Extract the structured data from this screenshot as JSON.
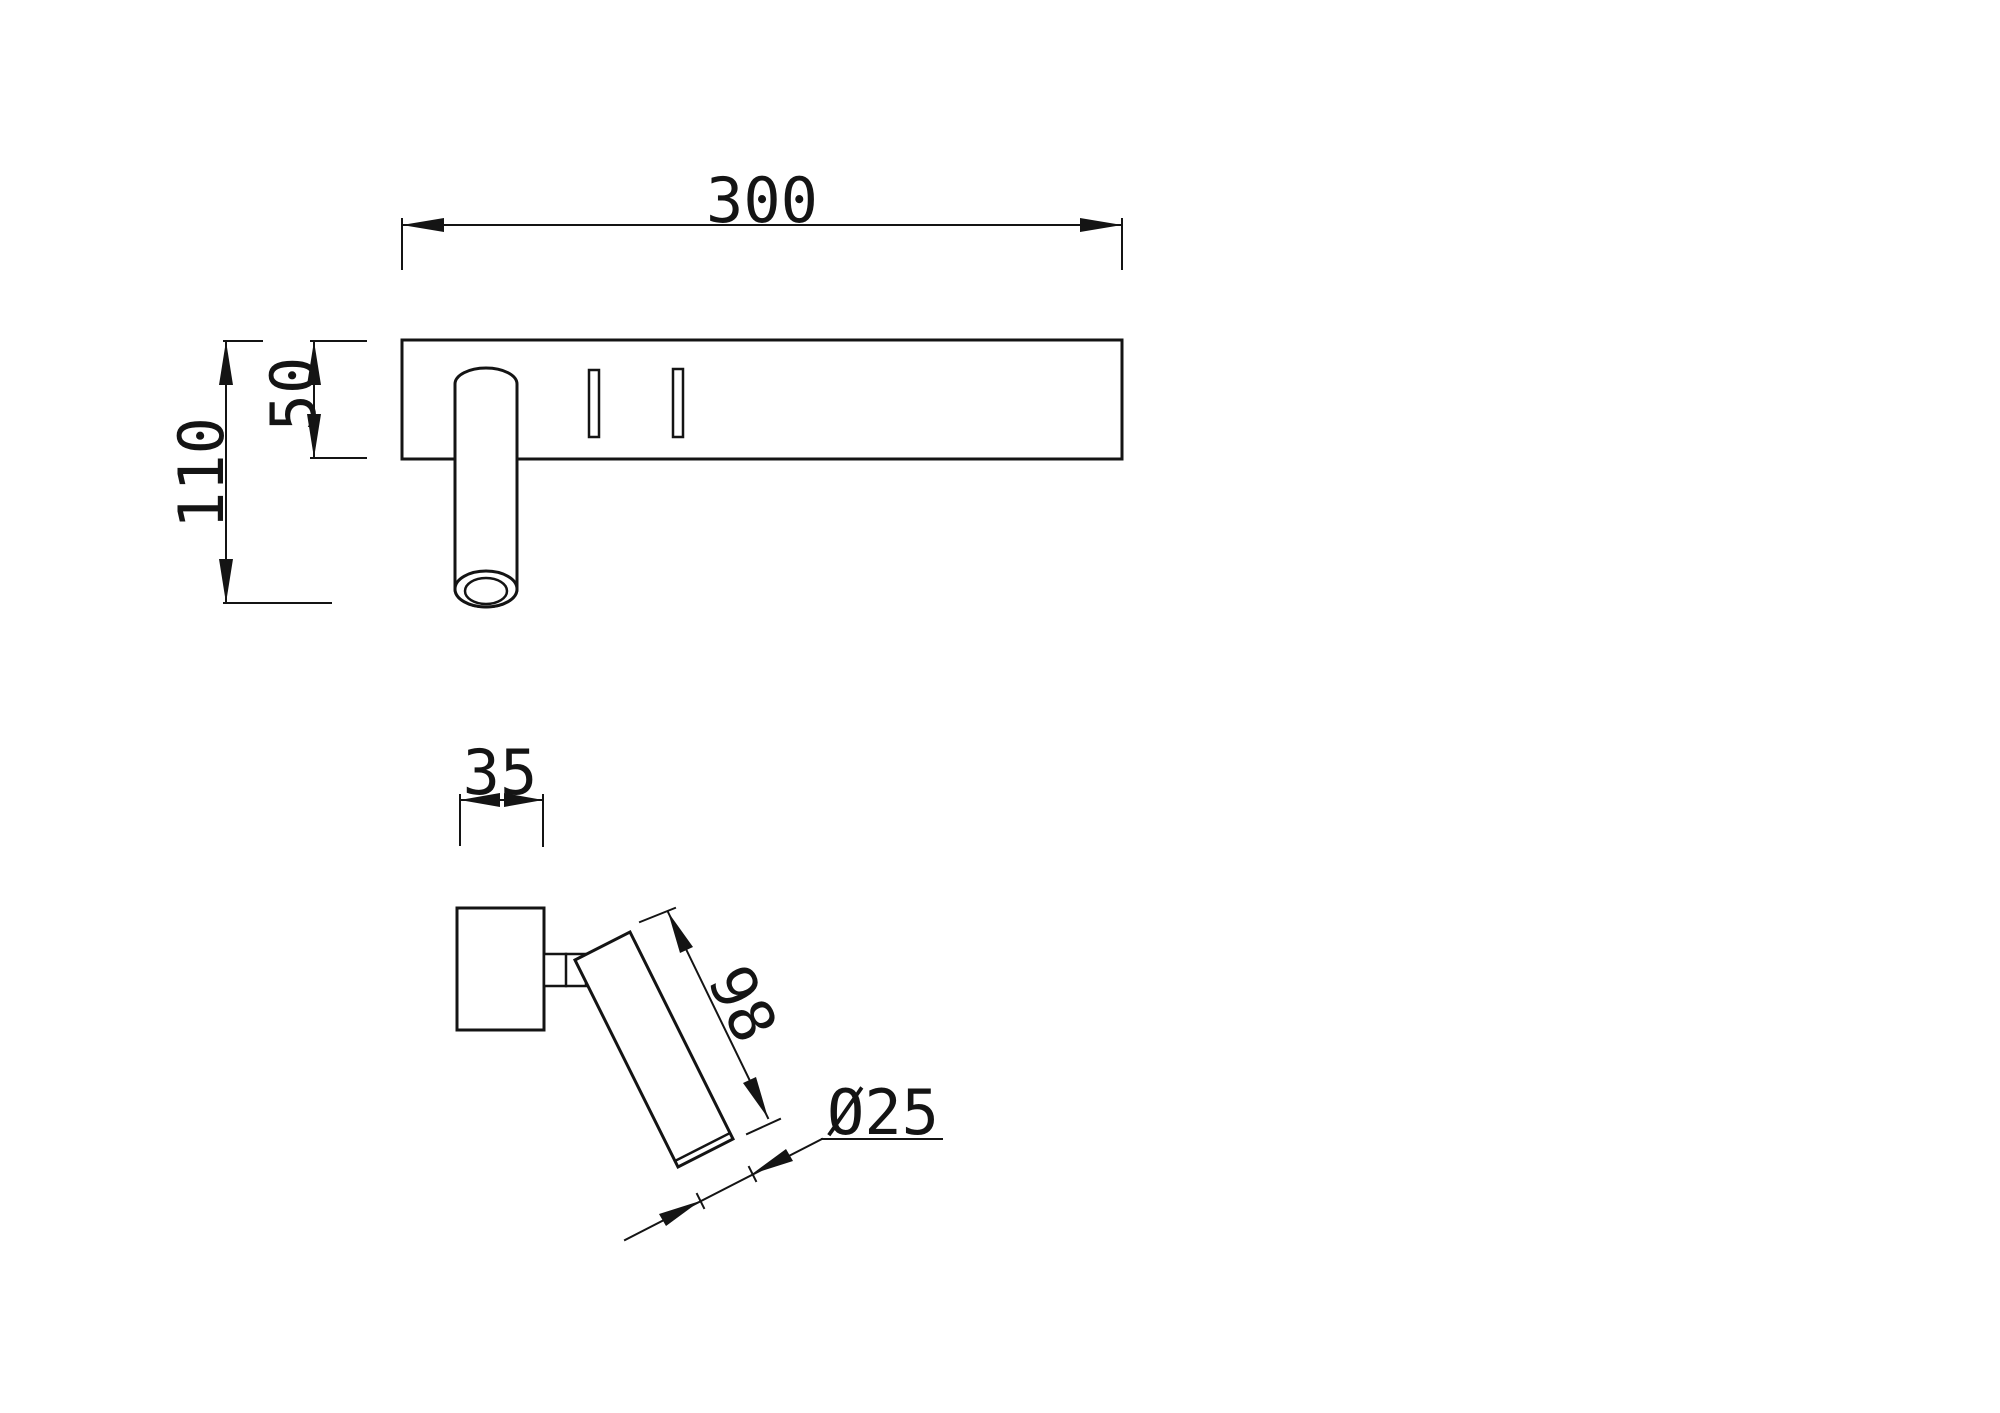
{
  "drawing": {
    "type": "technical-dimension-drawing",
    "background": "#ffffff",
    "line_color": "#141414",
    "views": {
      "front": {
        "name": "front elevation of wall lamp with headboard plate and reading spotlight tube",
        "dimensions": [
          {
            "id": "plate-width",
            "label": "300"
          },
          {
            "id": "total-height",
            "label": "110"
          },
          {
            "id": "plate-height",
            "label": "50"
          }
        ]
      },
      "side": {
        "name": "side profile with angled spotlight tube",
        "dimensions": [
          {
            "id": "plate-depth",
            "label": "35"
          },
          {
            "id": "tube-length",
            "label": "98"
          },
          {
            "id": "tube-diameter",
            "label": "Ø25"
          }
        ]
      }
    }
  }
}
